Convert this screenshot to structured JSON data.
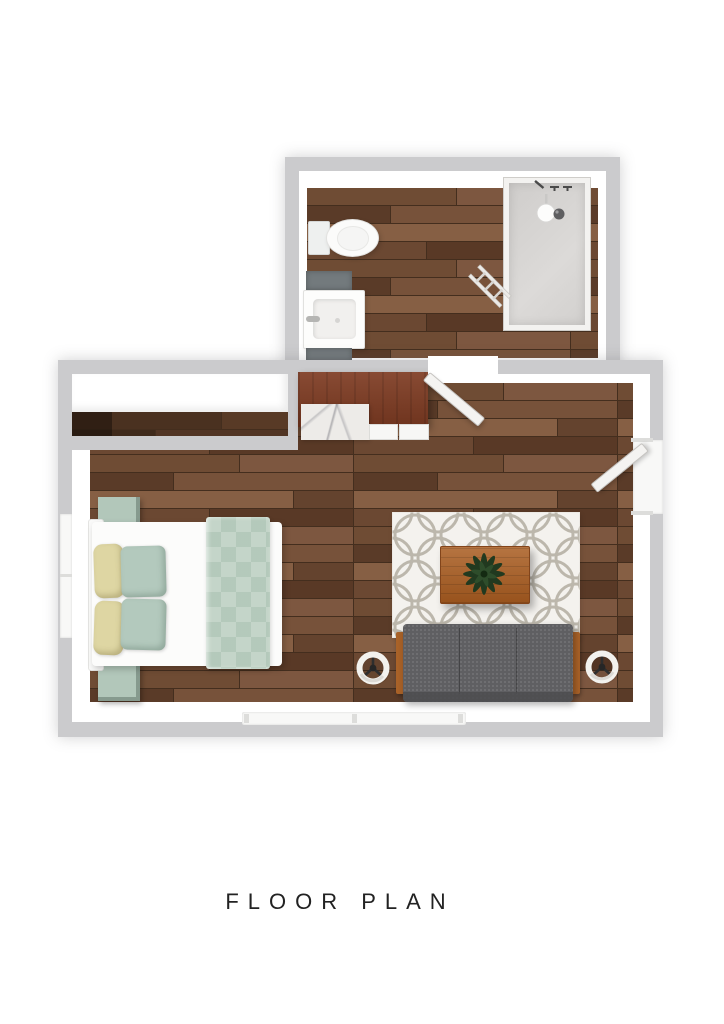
{
  "title": {
    "text": "FLOOR PLAN"
  },
  "palette": {
    "page_bg": "#ffffff",
    "wall_outer": "#cbcbcd",
    "wall_inner": "#ffffff",
    "plank_gap": "#442e1e",
    "counter_rust": "#7e3b22",
    "marble": "#edebe8",
    "tile_gray": "#737a7d",
    "shower_floor": "#d6d4d2",
    "fixture_white": "#fbfbfa",
    "sofa_body": "#5f5f62",
    "sofa_front": "#4c4c4f",
    "sofa_wood": "#a96228",
    "rug_base": "#f4f2ee",
    "rug_ring": "#bcb7ac",
    "bed_white": "#fcfcfb",
    "duvet_sage": "#c4d5c9",
    "pillow_sage": "#b3c9bd",
    "pillow_yellow": "#ded6a3",
    "nightstand_sage": "#b2c7ba",
    "table_wood": "#a95c20",
    "plant_green": "#21391f",
    "plant_green_light": "#2e4d2b",
    "door_white": "#f4f3f1",
    "window_white": "#f8f8f7",
    "title_color": "#222222"
  },
  "floor": {
    "main_planks": [
      "#6f4c34",
      "#7d5740",
      "#5a3b28",
      "#77523a",
      "#865f44",
      "#64432e",
      "#6b4832",
      "#593926",
      "#4e3322",
      "#8a6347"
    ],
    "closet_planks": [
      "#4a3120",
      "#583a26",
      "#3f2a1b",
      "#513524"
    ]
  },
  "objects": [
    "bathroom",
    "shower",
    "showerhead",
    "toilet",
    "sink-vanity",
    "bath-mats",
    "towel-ladder",
    "bathroom-door",
    "closet-shelf",
    "kitchen-counter",
    "marble-countertop",
    "cabinets",
    "entry-door",
    "bed",
    "headboard",
    "duvet",
    "pillows",
    "nightstands",
    "area-rug",
    "coffee-table",
    "plant",
    "sofa",
    "side-stools",
    "window-left",
    "window-bottom"
  ]
}
